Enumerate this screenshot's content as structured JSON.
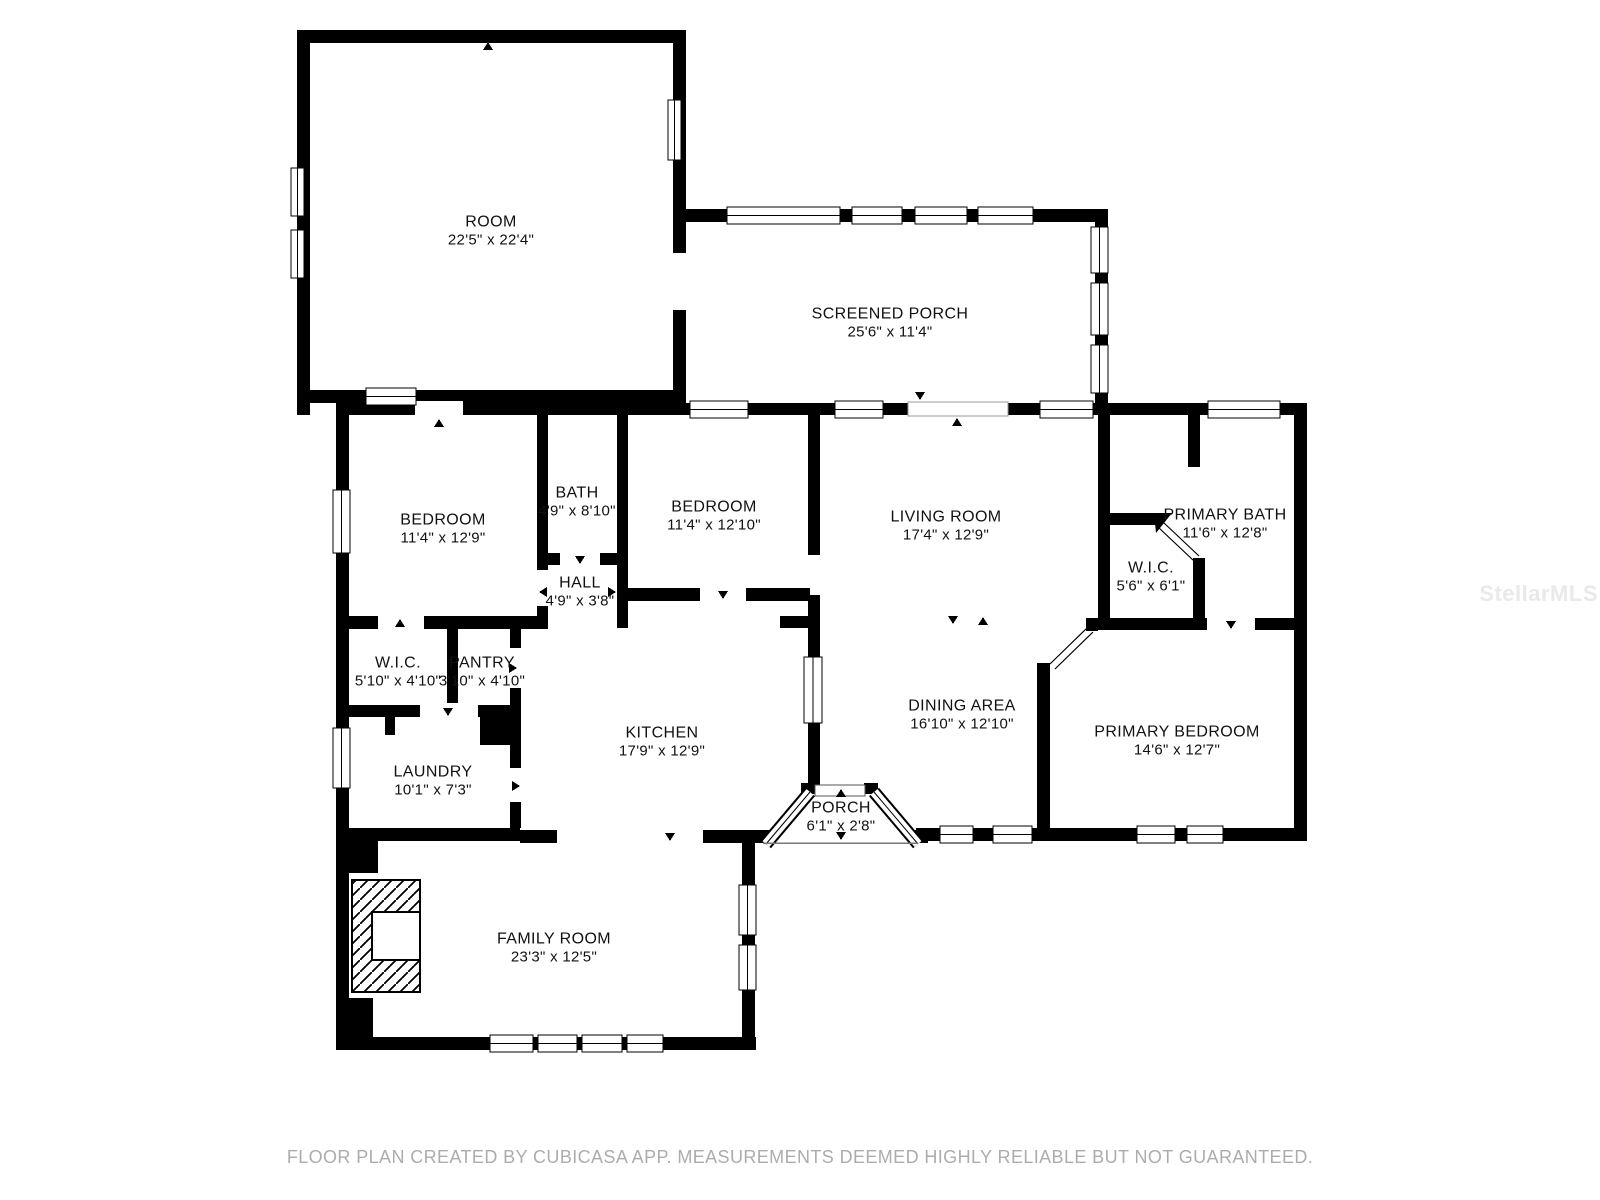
{
  "footer": {
    "text": "FLOOR PLAN CREATED BY CUBICASA APP. MEASUREMENTS DEEMED HIGHLY RELIABLE BUT NOT GUARANTEED."
  },
  "watermark": {
    "text": "StellarMLS"
  },
  "colors": {
    "wall": "#000000",
    "background": "#ffffff",
    "footer_text": "#aaadb0",
    "watermark_text": "#e9e9e9"
  },
  "rooms": [
    {
      "name": "ROOM",
      "dims": "22'5\" x 22'4\""
    },
    {
      "name": "SCREENED PORCH",
      "dims": "25'6\" x 11'4\""
    },
    {
      "name": "BEDROOM",
      "dims": "11'4\" x 12'9\""
    },
    {
      "name": "BATH",
      "dims": "4'9\" x 8'10\""
    },
    {
      "name": "BEDROOM",
      "dims": "11'4\" x 12'10\""
    },
    {
      "name": "LIVING ROOM",
      "dims": "17'4\" x 12'9\""
    },
    {
      "name": "PRIMARY BATH",
      "dims": "11'6\" x 12'8\""
    },
    {
      "name": "W.I.C.",
      "dims": "5'6\" x 6'1\""
    },
    {
      "name": "HALL",
      "dims": "4'9\" x 3'8\""
    },
    {
      "name": "W.I.C.",
      "dims": "5'10\" x 4'10\""
    },
    {
      "name": "PANTRY",
      "dims": "3'10\" x 4'10\""
    },
    {
      "name": "KITCHEN",
      "dims": "17'9\" x 12'9\""
    },
    {
      "name": "DINING AREA",
      "dims": "16'10\" x 12'10\""
    },
    {
      "name": "PRIMARY BEDROOM",
      "dims": "14'6\" x 12'7\""
    },
    {
      "name": "LAUNDRY",
      "dims": "10'1\" x 7'3\""
    },
    {
      "name": "PORCH",
      "dims": "6'1\" x 2'8\""
    },
    {
      "name": "FAMILY ROOM",
      "dims": "23'3\" x 12'5\""
    }
  ]
}
